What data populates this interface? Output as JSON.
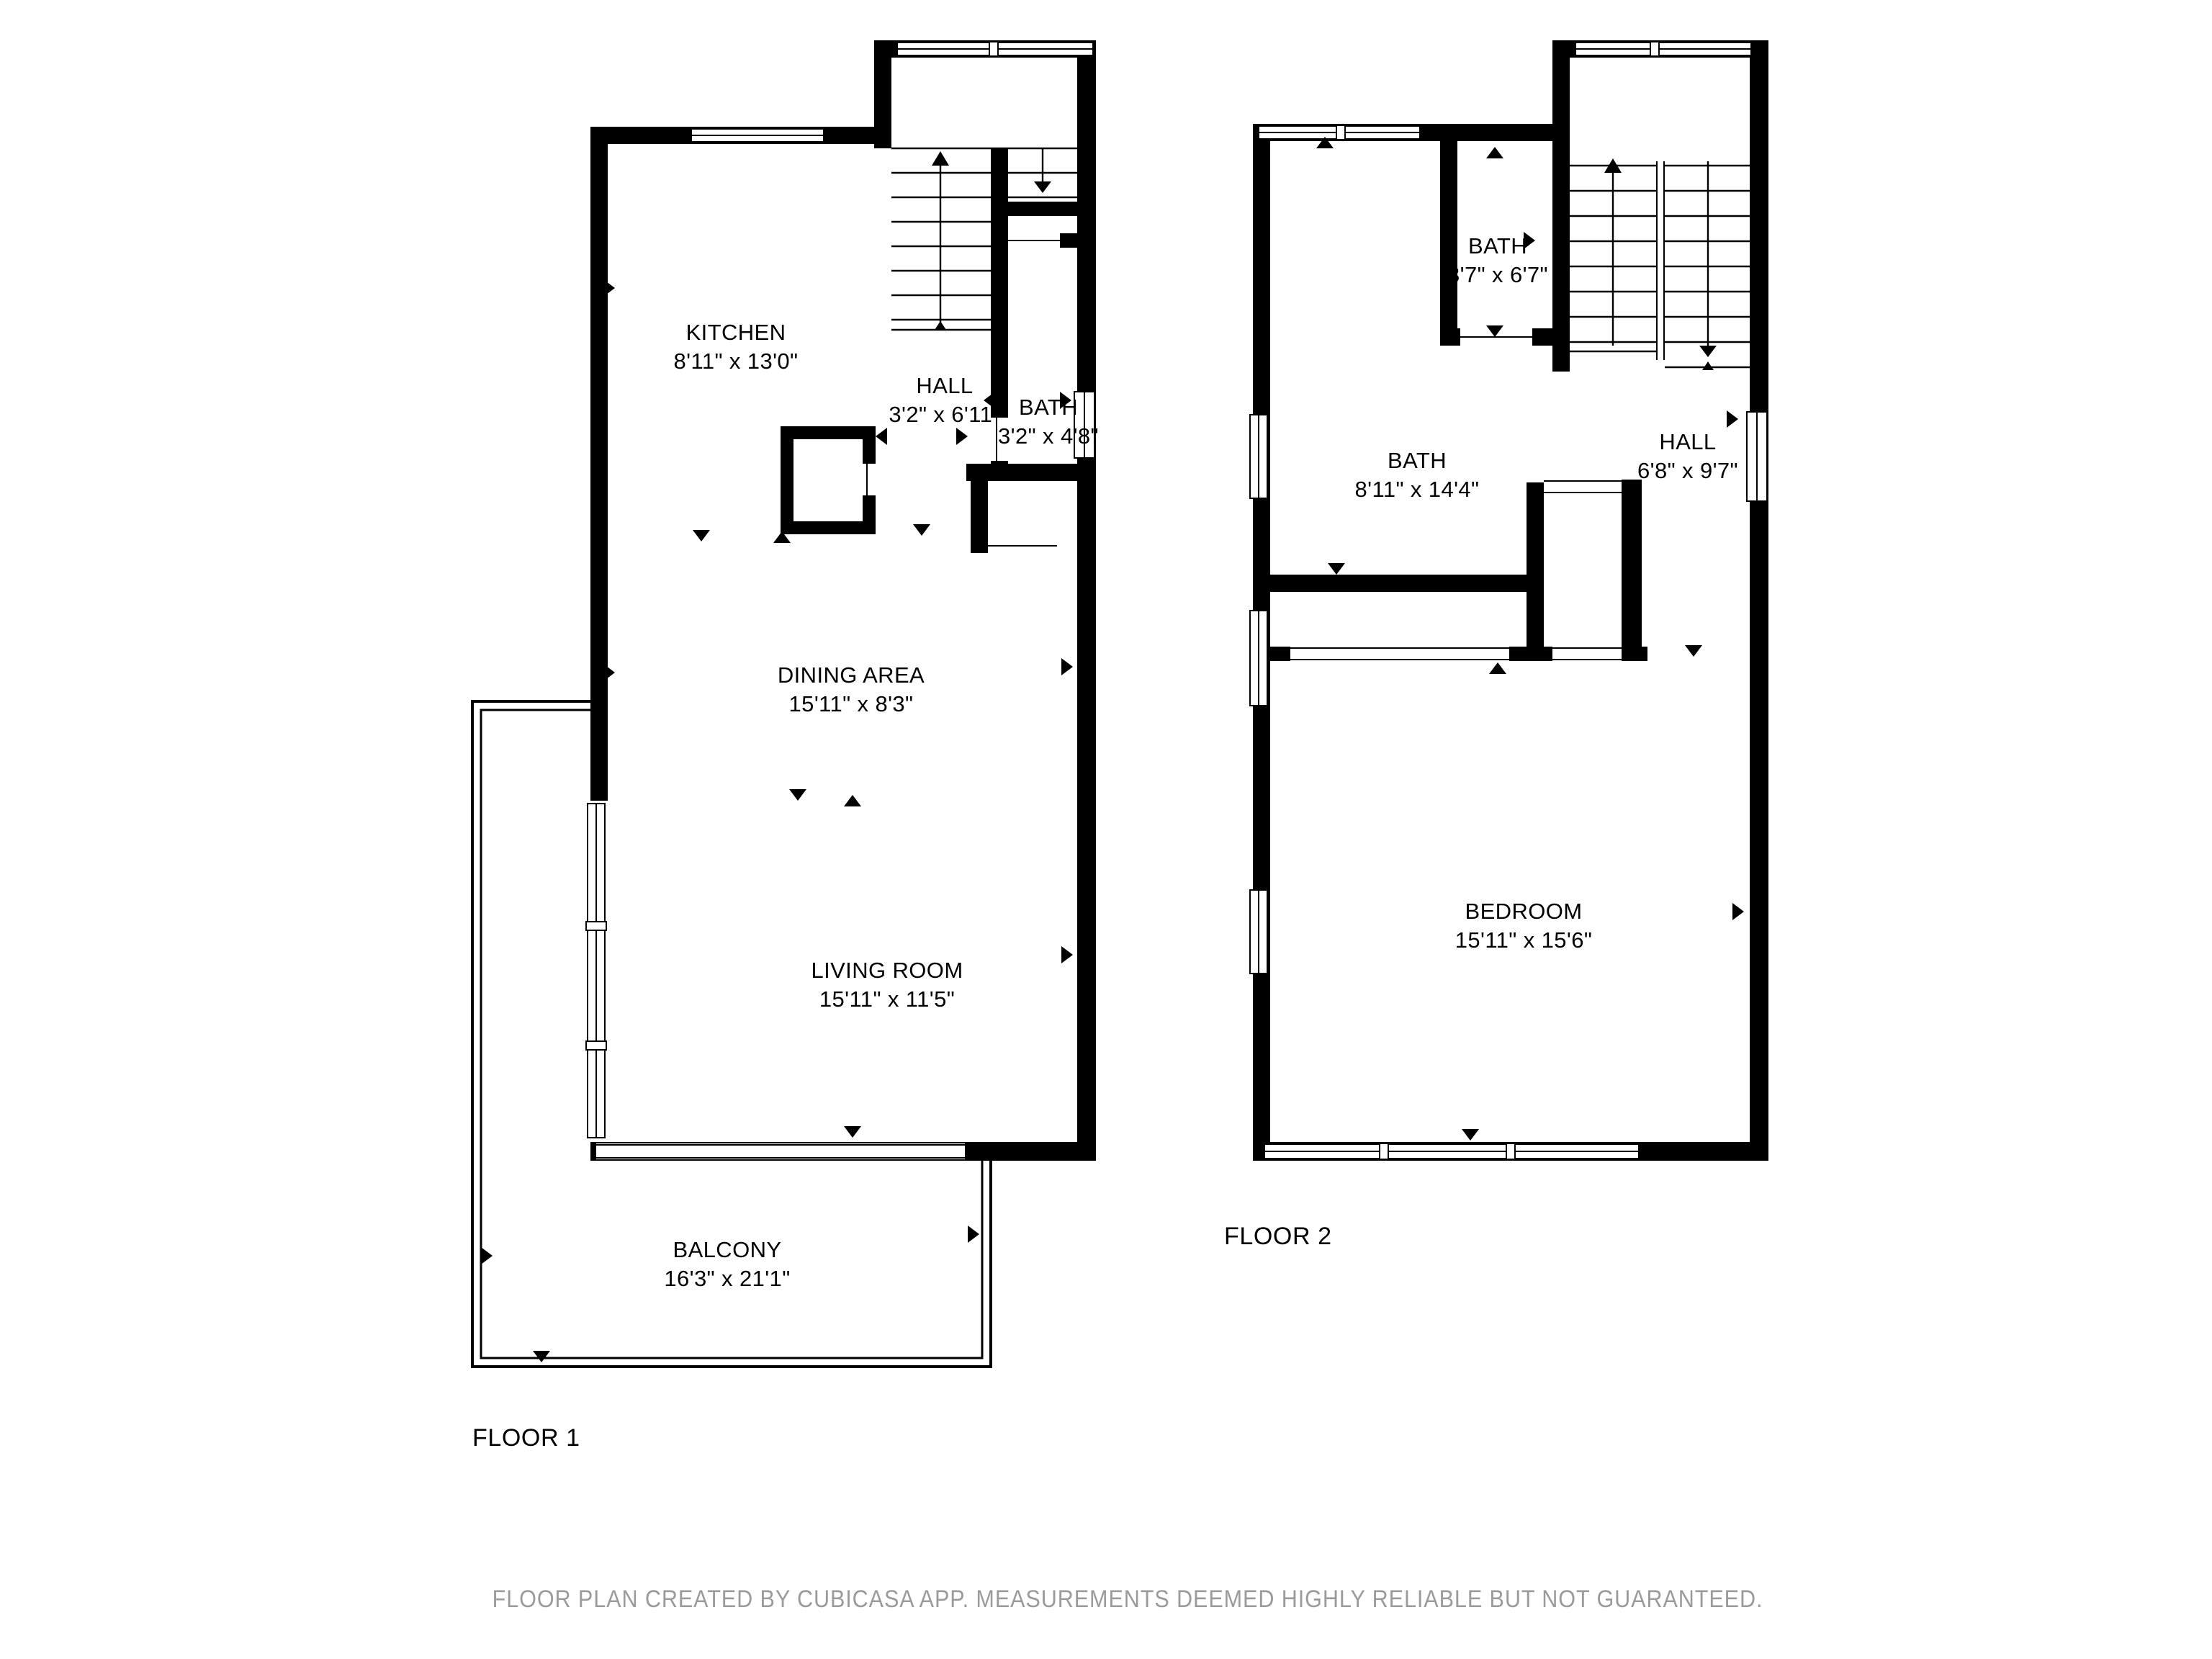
{
  "floor1": {
    "label": "FLOOR 1",
    "rooms": [
      {
        "id": "kitchen",
        "name": "KITCHEN",
        "dims": "8'11\" x 13'0\""
      },
      {
        "id": "hall",
        "name": "HALL",
        "dims": "3'2\" x 6'11\""
      },
      {
        "id": "bath",
        "name": "BATH",
        "dims": "3'2\" x 4'8\""
      },
      {
        "id": "dining-area",
        "name": "DINING AREA",
        "dims": "15'11\" x 8'3\""
      },
      {
        "id": "living-room",
        "name": "LIVING ROOM",
        "dims": "15'11\" x 11'5\""
      },
      {
        "id": "balcony",
        "name": "BALCONY",
        "dims": "16'3\" x 21'1\""
      }
    ]
  },
  "floor2": {
    "label": "FLOOR 2",
    "rooms": [
      {
        "id": "bath-small",
        "name": "BATH",
        "dims": "3'7\" x 6'7\""
      },
      {
        "id": "bath-large",
        "name": "BATH",
        "dims": "8'11\" x 14'4\""
      },
      {
        "id": "hall",
        "name": "HALL",
        "dims": "6'8\" x 9'7\""
      },
      {
        "id": "bedroom",
        "name": "BEDROOM",
        "dims": "15'11\" x 15'6\""
      }
    ]
  },
  "footer": {
    "disclaimer": "FLOOR PLAN CREATED BY CUBICASA APP. MEASUREMENTS DEEMED HIGHLY RELIABLE BUT NOT GUARANTEED."
  },
  "colors": {
    "wall": "#000000",
    "background": "#ffffff",
    "disclaimer_text": "#9b9b9b"
  }
}
